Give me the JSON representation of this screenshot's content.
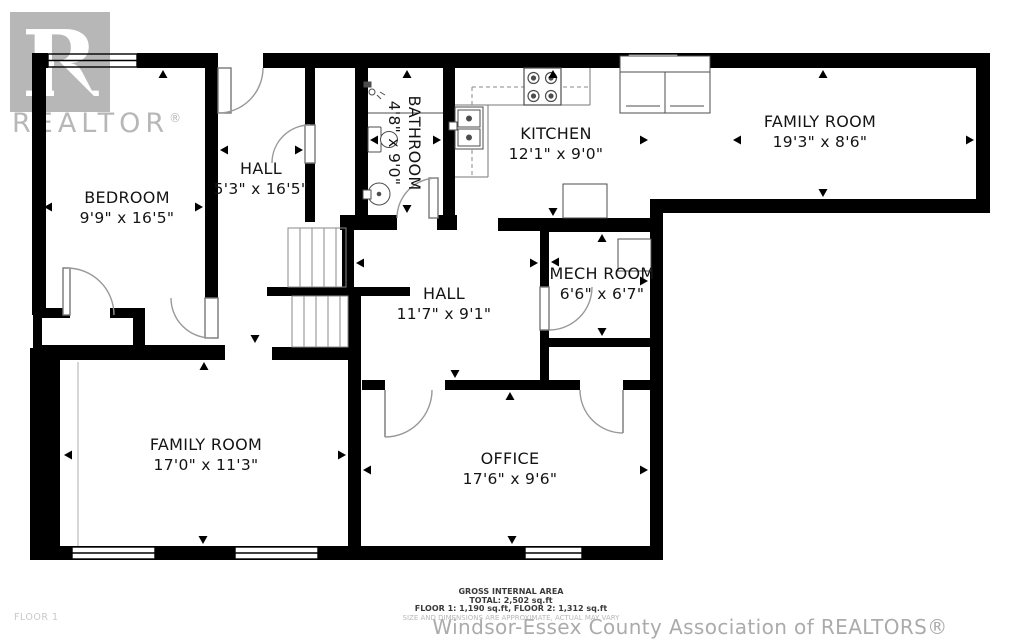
{
  "plan": {
    "floor_label": "FLOOR 1",
    "rooms": [
      {
        "id": "bedroom",
        "name": "BEDROOM",
        "dims": "9'9\" x 16'5\""
      },
      {
        "id": "hall-upper",
        "name": "HALL",
        "dims": "5'3\" x 16'5\""
      },
      {
        "id": "bathroom",
        "name": "BATHROOM",
        "dims": "4'8\" x 9'0\""
      },
      {
        "id": "kitchen",
        "name": "KITCHEN",
        "dims": "12'1\" x 9'0\""
      },
      {
        "id": "family-room-upper",
        "name": "FAMILY ROOM",
        "dims": "19'3\" x 8'6\""
      },
      {
        "id": "mech-room",
        "name": "MECH ROOM",
        "dims": "6'6\" x 6'7\""
      },
      {
        "id": "hall-main",
        "name": "HALL",
        "dims": "11'7\" x 9'1\""
      },
      {
        "id": "family-room-lower",
        "name": "FAMILY ROOM",
        "dims": "17'0\" x 11'3\""
      },
      {
        "id": "office",
        "name": "OFFICE",
        "dims": "17'6\" x 9'6\""
      }
    ]
  },
  "watermark": {
    "logo_letter": "R",
    "logo_text": "REALTOR",
    "registered": "®",
    "association": "Windsor-Essex County Association of REALTORS®"
  },
  "footer": {
    "area_title": "GROSS INTERNAL AREA",
    "total": "TOTAL: 2,502 sq.ft",
    "floors": "FLOOR 1: 1,190 sq.ft, FLOOR 2: 1,312 sq.ft",
    "disclaimer": "SIZE AND DIMENSIONS ARE APPROXIMATE, ACTUAL MAY VARY"
  },
  "colors": {
    "wall": "#000000",
    "fixture_line": "#4d4d4d",
    "door_arc": "#999999",
    "watermark_gray": "#b7b7b7",
    "label_text": "#141414"
  }
}
